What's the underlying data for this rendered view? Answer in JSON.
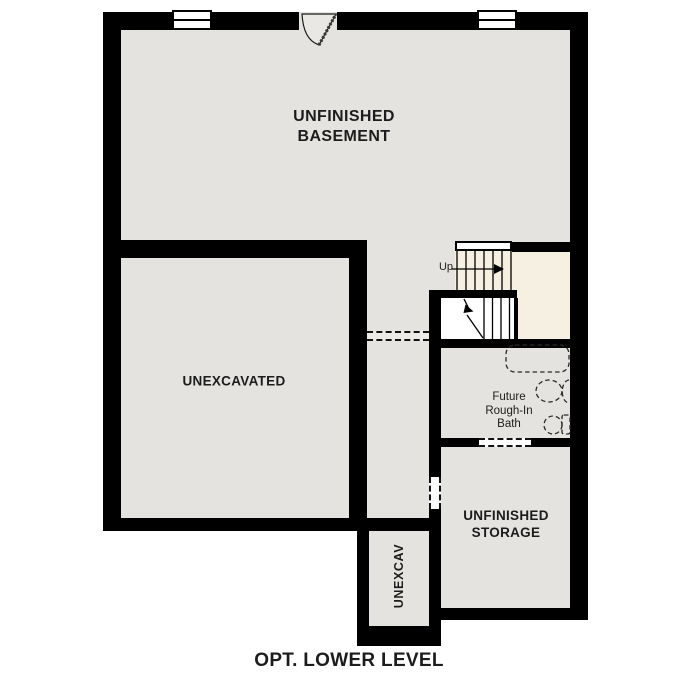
{
  "title": "OPT. LOWER LEVEL",
  "rooms": {
    "basement": {
      "label": "UNFINISHED\nBASEMENT"
    },
    "unexcavated": {
      "label": "UNEXCAVATED"
    },
    "bath": {
      "label": "Future\nRough-In\nBath"
    },
    "storage": {
      "label": "UNFINISHED\nSTORAGE"
    },
    "unexcav_small": {
      "label": "UNEXCAV"
    }
  },
  "stairs": {
    "direction_label": "Up"
  },
  "symbols": {
    "windows": [
      "window-symbol-left",
      "window-symbol-right"
    ],
    "door": "entry-door-swing-icon",
    "stairs": [
      "stair-treads-icon",
      "stair-up-arrow-icon",
      "stair-break-line-icon"
    ],
    "bath_fixtures": [
      "bathtub-icon",
      "sink-icon",
      "toilet-icon"
    ],
    "openings": [
      "corridor-cased-opening",
      "storage-side-opening",
      "bath-storage-opening"
    ]
  },
  "colors": {
    "wall": "#000000",
    "floor": "#e4e3e0",
    "stair_landing": "#f6f0e2",
    "door_leaf_fill": "#e9e8e5",
    "background": "#ffffff"
  }
}
